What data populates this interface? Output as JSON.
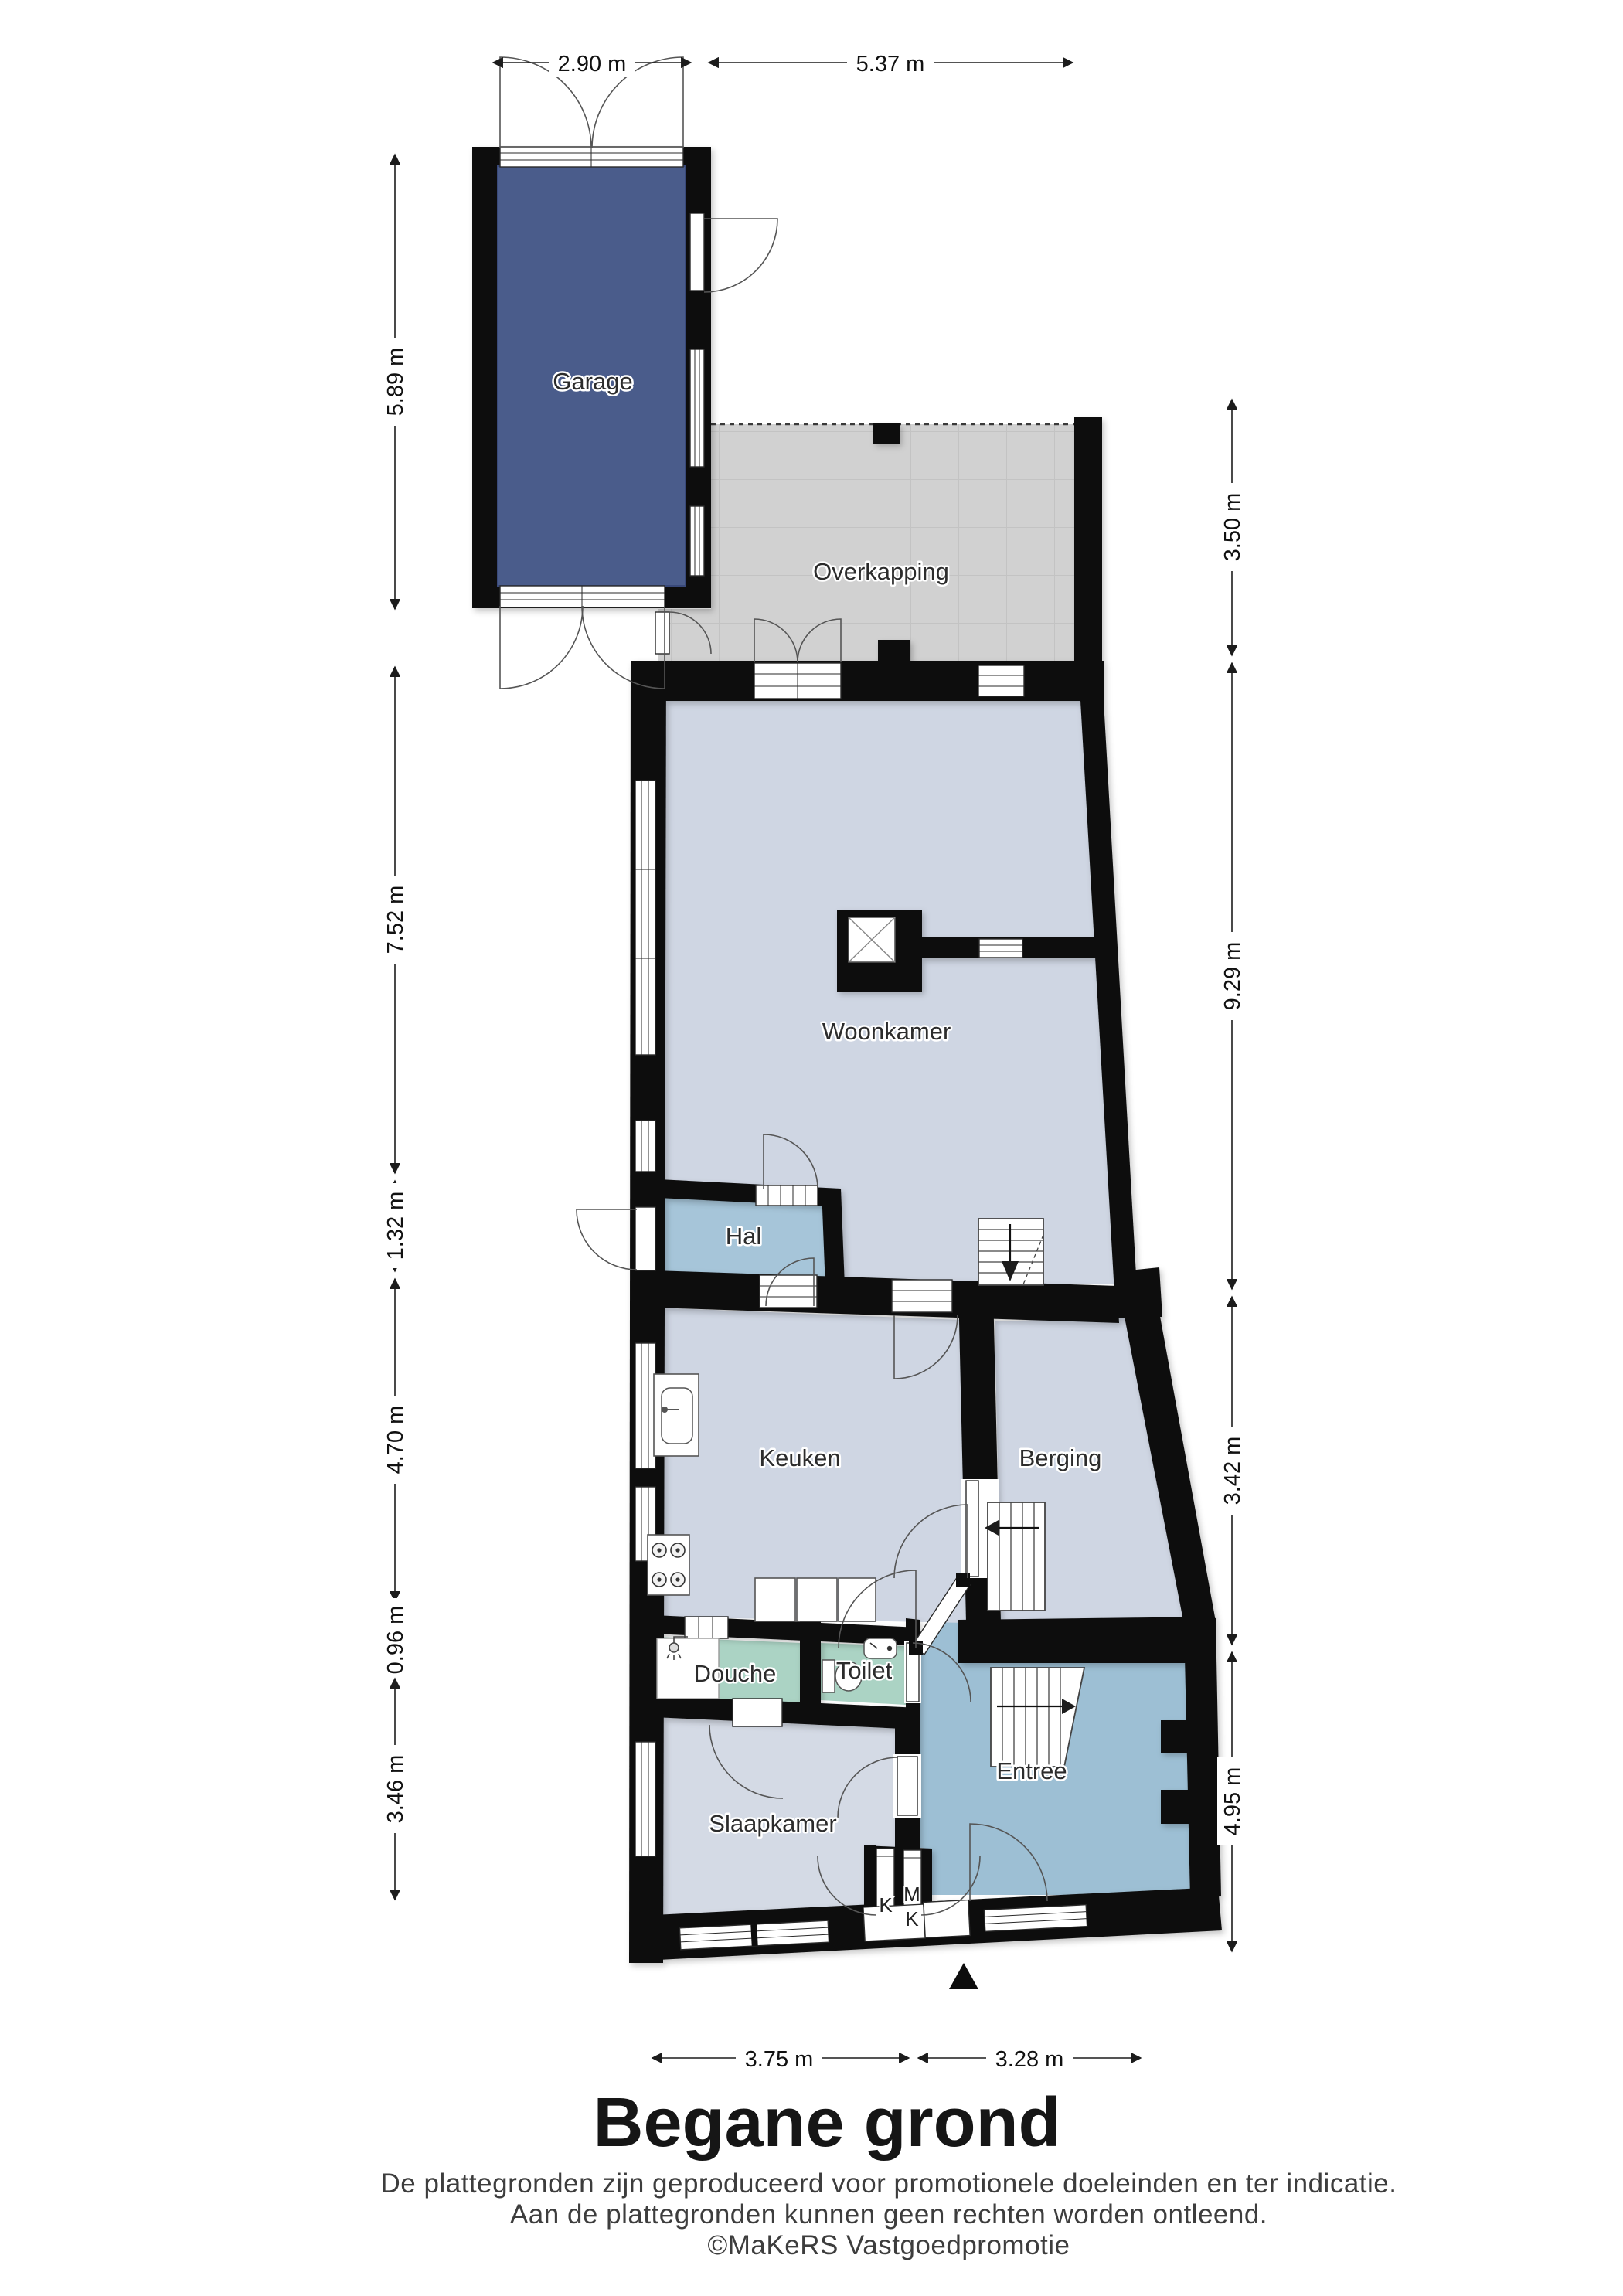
{
  "title": "Begane grond",
  "footer": {
    "line1": "De plattegronden zijn geproduceerd voor promotionele doeleinden en ter indicatie.",
    "line2": "Aan de plattegronden kunnen geen rechten worden ontleend.",
    "line3": "©MaKeRS Vastgoedpromotie"
  },
  "rooms": {
    "garage": "Garage",
    "overkapping": "Overkapping",
    "woonkamer": "Woonkamer",
    "hal": "Hal",
    "keuken": "Keuken",
    "berging": "Berging",
    "douche": "Douche",
    "toilet": "Toilet",
    "slaapkamer": "Slaapkamer",
    "entree": "Entree"
  },
  "closets": {
    "k": "K",
    "m": "M",
    "k2": "K"
  },
  "dimensions": {
    "top": [
      "2.90 m",
      "5.37 m"
    ],
    "left": [
      "5.89 m",
      "7.52 m",
      "1.32 m",
      "4.70 m",
      "0.96 m",
      "3.46 m"
    ],
    "right": [
      "3.50 m",
      "9.29 m",
      "3.42 m",
      "4.95 m"
    ],
    "bottom": [
      "3.75 m",
      "3.28 m"
    ]
  },
  "colors": {
    "garage_fill": "#4a5c8b",
    "room_fill": "#cfd6e3",
    "hal_fill": "#a6c5d9",
    "entree_fill": "#9dbfd4",
    "sanitary_fill": "#abd3c4",
    "overkapping_fill": "#d1d1d1",
    "wall": "#0d0d0d"
  }
}
